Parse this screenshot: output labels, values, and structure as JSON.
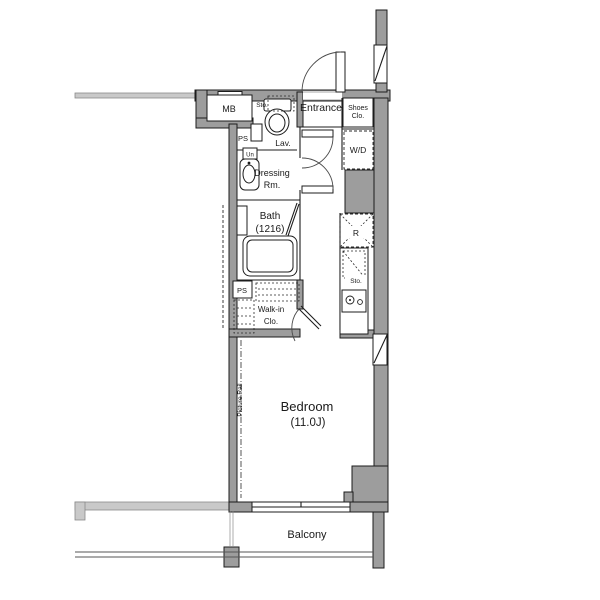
{
  "floor_plan": {
    "labels": {
      "meter_box": "MB",
      "pipe_space_upper": "PS",
      "toilet_storage": "Sto.",
      "lavatory": "Lav.",
      "washbasin_unit": "Un",
      "dressing_room": [
        "Dressing",
        "Rm."
      ],
      "bath": [
        "Bath",
        "(1216)"
      ],
      "entrance": "Entrance",
      "shoes_closet": [
        "Shoes",
        "Clo."
      ],
      "washer_dryer": "W/D",
      "refrigerator_space": "R",
      "kitchen_storage": "Sto.",
      "pipe_space_lower": "PS",
      "walk_in_closet": [
        "Walk-in",
        "Clo."
      ],
      "picture_rail": "Picture Rail",
      "bedroom": [
        "Bedroom",
        "(11.0J)"
      ],
      "balcony": "Balcony"
    },
    "colors": {
      "wall_fill": "#9d9d9d",
      "wall_light": "#c9c9c9",
      "line": "#1c1c1c",
      "background": "#ffffff"
    }
  }
}
